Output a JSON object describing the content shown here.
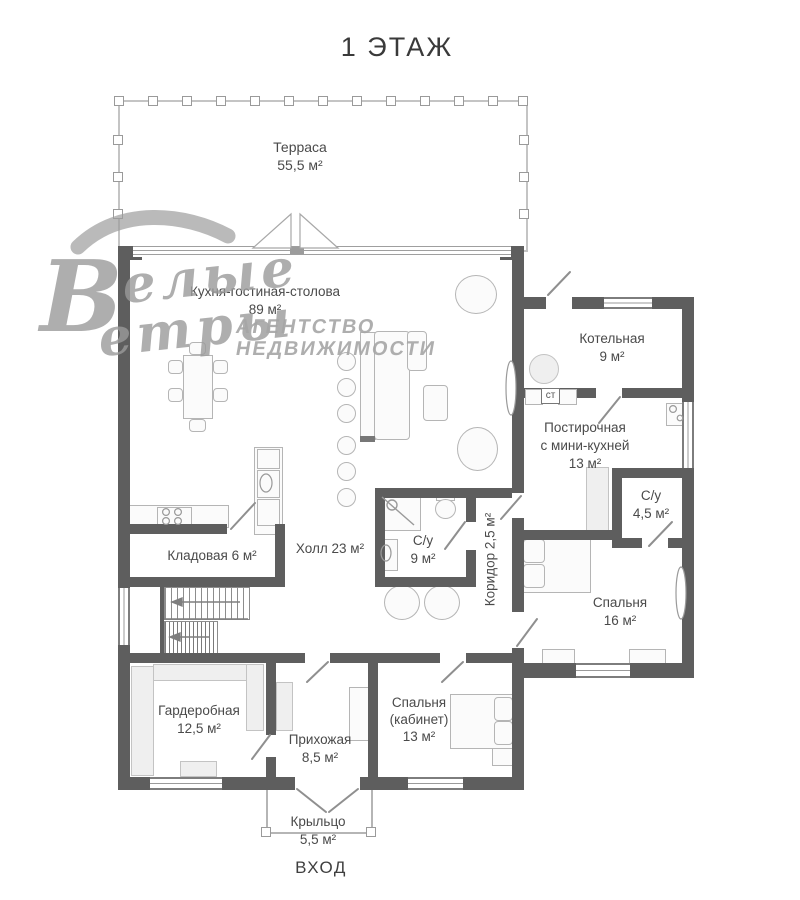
{
  "title": "1 ЭТАЖ",
  "entrance_label": "ВХОД",
  "watermark": {
    "big_letter": "В",
    "script_line1": "елые",
    "script_line2": "етры",
    "agency_line1": "АГЕНТСТВО",
    "agency_line2": "НЕДВИЖИМОСТИ"
  },
  "labels": {
    "washing_machine": "ст"
  },
  "rooms": [
    {
      "name": "Терраса",
      "area": "55,5 м²"
    },
    {
      "name": "Кухня-гостиная-столова",
      "area": "89 м²"
    },
    {
      "name": "Котельная",
      "area": "9 м²"
    },
    {
      "name": "Постирочная",
      "name2": "с мини-кухней",
      "area": "13 м²"
    },
    {
      "name": "С/у",
      "area": "4,5 м²"
    },
    {
      "name": "Кладовая",
      "area": "6 м²"
    },
    {
      "name": "Холл",
      "area": "23 м²"
    },
    {
      "name": "С/у",
      "area": "9 м²"
    },
    {
      "name": "Коридор",
      "area": "2,5 м²"
    },
    {
      "name": "Спальня",
      "area": "16 м²"
    },
    {
      "name": "Гардеробная",
      "area": "12,5 м²"
    },
    {
      "name": "Прихожая",
      "area": "8,5 м²"
    },
    {
      "name": "Спальня",
      "name2": "(кабинет)",
      "area": "13 м²"
    },
    {
      "name": "Крыльцо",
      "area": "5,5 м²"
    }
  ],
  "colors": {
    "wall": "#5e5e5e",
    "label_text": "#4a4a4a",
    "watermark": "#9b9b9b"
  }
}
